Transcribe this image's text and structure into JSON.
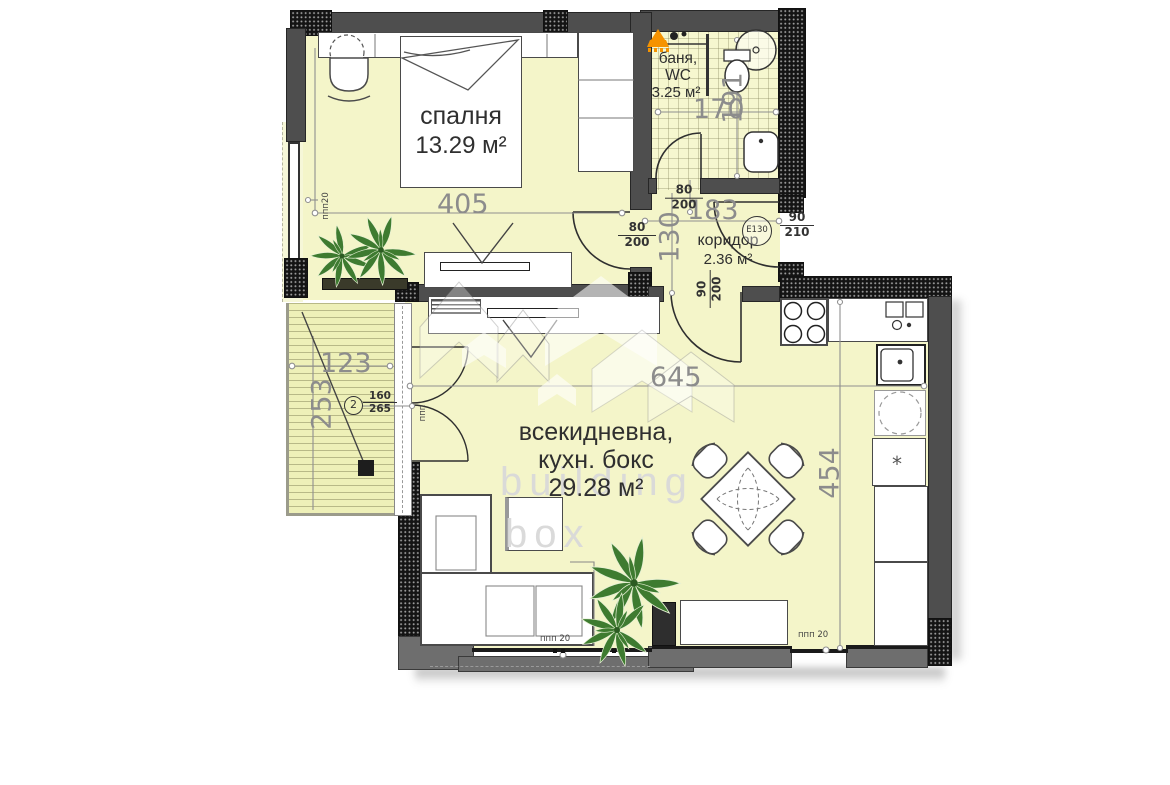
{
  "watermark": {
    "line1": "building",
    "line2": "box"
  },
  "rooms": {
    "bedroom": {
      "name": "спалня",
      "area": "13.29 м²"
    },
    "bathroom": {
      "name_line1": "баня,",
      "name_line2": "WC",
      "area": "3.25 м²"
    },
    "corridor": {
      "name": "коридор",
      "area": "2.36 м²"
    },
    "living": {
      "name_line1": "всекидневна,",
      "name_line2": "кухн. бокс",
      "area": "29.28 м²"
    }
  },
  "dimensions": {
    "bedroom_width": "405",
    "living_width": "645",
    "living_depth": "454",
    "corridor_width": "183",
    "corridor_depth": "130",
    "bathroom_width": "170",
    "bathroom_depth": "191",
    "balcony_width": "123",
    "balcony_depth": "253"
  },
  "openings": {
    "bedroom_door": {
      "width": "80",
      "height": "200"
    },
    "bathroom_door": {
      "width": "80",
      "height": "200"
    },
    "living_room_door": {
      "width": "90",
      "height": "200"
    },
    "entrance_door": {
      "width": "90",
      "height": "210",
      "fire_rating": "E130"
    },
    "balcony_door": {
      "index": "2",
      "width": "160",
      "height": "265"
    }
  },
  "markers": {
    "bedroom_window": "ппп20",
    "balcony_door_frame": "ппп",
    "living_window_left": "ппп 20",
    "living_window_right": "ппп 20",
    "freezer_symbol": "*"
  },
  "colors": {
    "floor": "#f4f5c9",
    "balcony_deck": "#eef0b8",
    "wall_gray": "#4e4e4e",
    "wall_hatch": "#161616",
    "heater_orange": "#f59300",
    "plant_green": "#3e7b30",
    "dimension_text": "#8c8c8c",
    "label_text": "#2f2f2f",
    "watermark_text": "#d9d9d9"
  }
}
